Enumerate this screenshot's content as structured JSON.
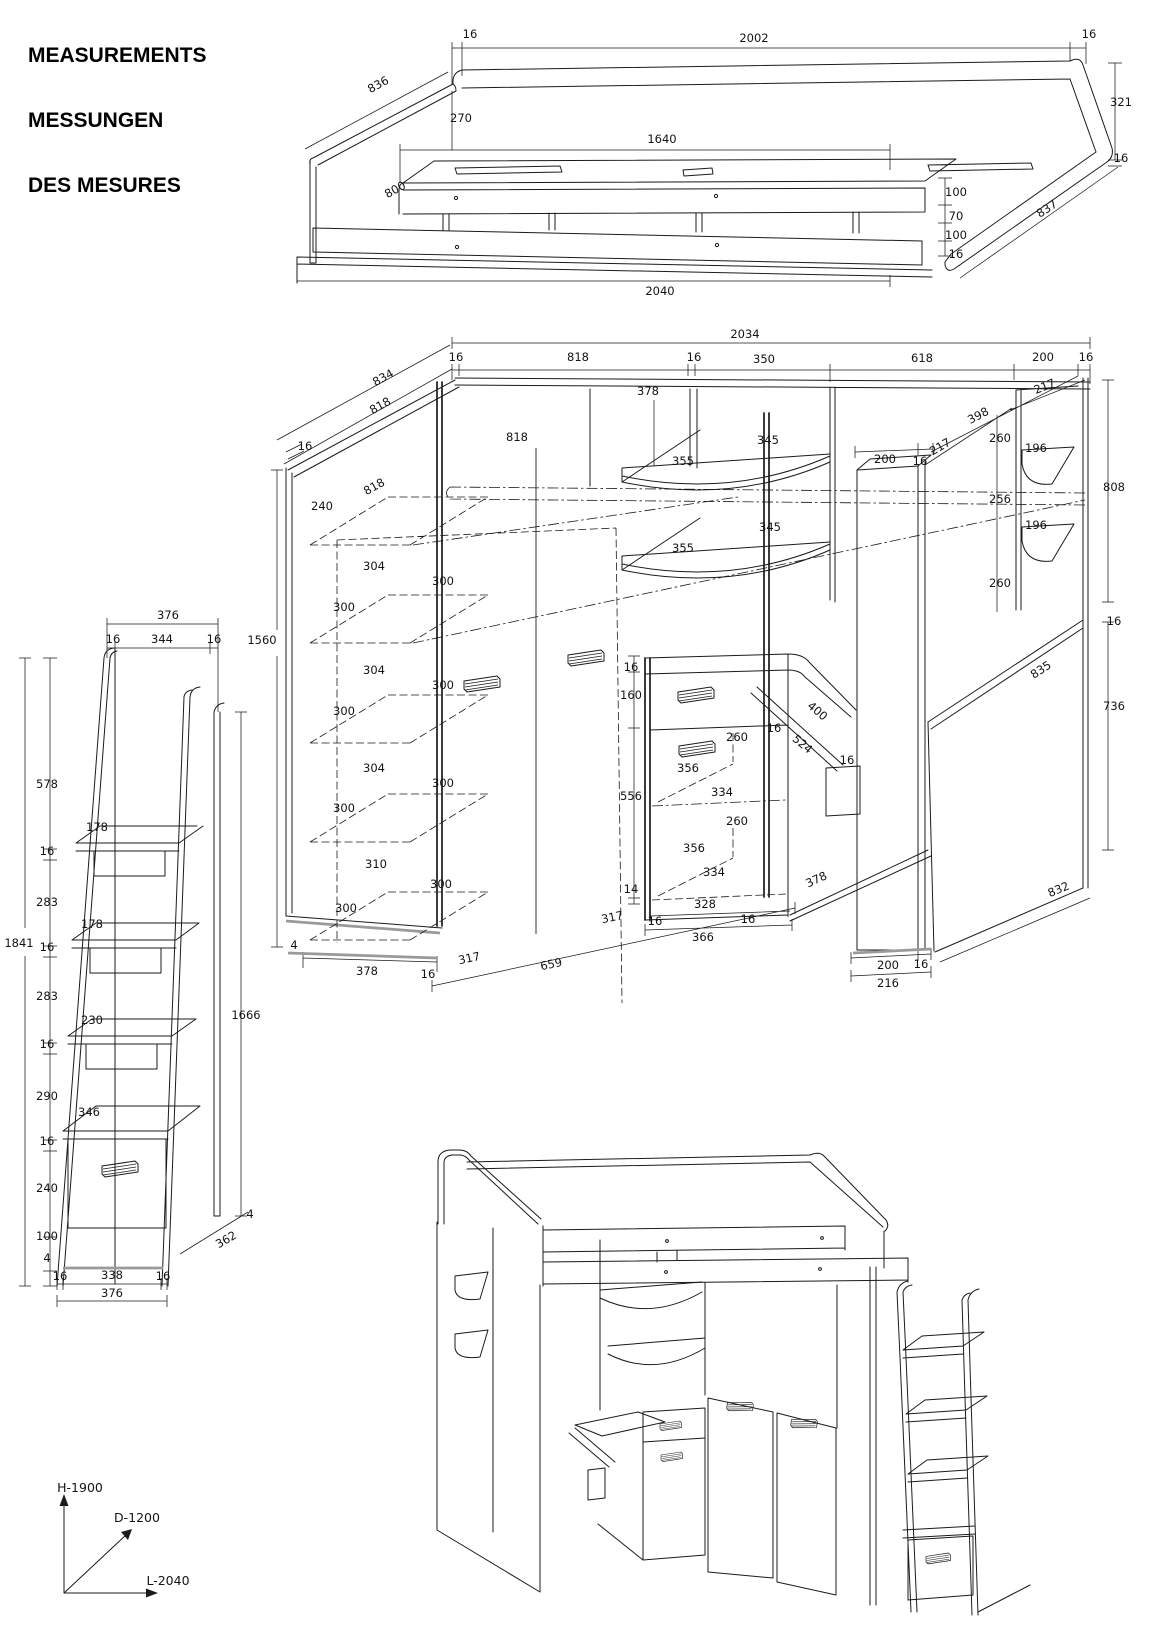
{
  "title": {
    "en": "MEASUREMENTS",
    "de": "MESSUNGEN",
    "fr": "DES MESURES"
  },
  "axes": {
    "height": "H-1900",
    "depth": "D-1200",
    "length": "L-2040"
  },
  "views": {
    "bed": {
      "name": "bed-frame-isometric",
      "labels": [
        {
          "x": 470,
          "y": 38,
          "t": "16"
        },
        {
          "x": 754,
          "y": 42,
          "t": "2002"
        },
        {
          "x": 1089,
          "y": 38,
          "t": "16"
        },
        {
          "x": 380,
          "y": 88,
          "t": "836",
          "r": -29
        },
        {
          "x": 461,
          "y": 122,
          "t": "270"
        },
        {
          "x": 662,
          "y": 143,
          "t": "1640"
        },
        {
          "x": 397,
          "y": 193,
          "t": "800",
          "r": -29
        },
        {
          "x": 1121,
          "y": 106,
          "t": "321",
          "a": "start"
        },
        {
          "x": 1121,
          "y": 162,
          "t": "16",
          "a": "start"
        },
        {
          "x": 956,
          "y": 196,
          "t": "100",
          "a": "start"
        },
        {
          "x": 956,
          "y": 220,
          "t": "70",
          "a": "start"
        },
        {
          "x": 956,
          "y": 239,
          "t": "100",
          "a": "start"
        },
        {
          "x": 956,
          "y": 258,
          "t": "16",
          "a": "start"
        },
        {
          "x": 1049,
          "y": 212,
          "t": "837",
          "r": -33
        },
        {
          "x": 660,
          "y": 295,
          "t": "2040"
        }
      ]
    },
    "unit": {
      "name": "wardrobe-desk-unit-isometric",
      "labels": [
        {
          "x": 745,
          "y": 338,
          "t": "2034"
        },
        {
          "x": 456,
          "y": 361,
          "t": "16"
        },
        {
          "x": 578,
          "y": 361,
          "t": "818"
        },
        {
          "x": 694,
          "y": 361,
          "t": "16"
        },
        {
          "x": 764,
          "y": 363,
          "t": "350"
        },
        {
          "x": 922,
          "y": 362,
          "t": "618"
        },
        {
          "x": 1043,
          "y": 361,
          "t": "200"
        },
        {
          "x": 1086,
          "y": 361,
          "t": "16"
        },
        {
          "x": 385,
          "y": 381,
          "t": "834",
          "r": -29
        },
        {
          "x": 382,
          "y": 409,
          "t": "818",
          "r": -29
        },
        {
          "x": 648,
          "y": 395,
          "t": "378"
        },
        {
          "x": 517,
          "y": 441,
          "t": "818"
        },
        {
          "x": 305,
          "y": 450,
          "t": "16"
        },
        {
          "x": 376,
          "y": 490,
          "t": "818",
          "r": -29
        },
        {
          "x": 322,
          "y": 510,
          "t": "240"
        },
        {
          "x": 262,
          "y": 644,
          "t": "1560"
        },
        {
          "x": 374,
          "y": 570,
          "t": "304"
        },
        {
          "x": 443,
          "y": 585,
          "t": "300"
        },
        {
          "x": 344,
          "y": 611,
          "t": "300"
        },
        {
          "x": 374,
          "y": 674,
          "t": "304"
        },
        {
          "x": 443,
          "y": 689,
          "t": "300"
        },
        {
          "x": 344,
          "y": 715,
          "t": "300"
        },
        {
          "x": 374,
          "y": 772,
          "t": "304"
        },
        {
          "x": 443,
          "y": 787,
          "t": "300"
        },
        {
          "x": 344,
          "y": 812,
          "t": "300"
        },
        {
          "x": 376,
          "y": 868,
          "t": "310"
        },
        {
          "x": 441,
          "y": 888,
          "t": "300"
        },
        {
          "x": 346,
          "y": 912,
          "t": "300"
        },
        {
          "x": 294,
          "y": 949,
          "t": "4"
        },
        {
          "x": 367,
          "y": 975,
          "t": "378"
        },
        {
          "x": 683,
          "y": 465,
          "t": "355"
        },
        {
          "x": 768,
          "y": 444,
          "t": "345"
        },
        {
          "x": 683,
          "y": 552,
          "t": "355"
        },
        {
          "x": 770,
          "y": 531,
          "t": "345"
        },
        {
          "x": 885,
          "y": 463,
          "t": "200"
        },
        {
          "x": 920,
          "y": 465,
          "t": "16"
        },
        {
          "x": 942,
          "y": 450,
          "t": "217",
          "r": -30
        },
        {
          "x": 980,
          "y": 419,
          "t": "398",
          "r": -28
        },
        {
          "x": 1046,
          "y": 390,
          "t": "217",
          "r": -22
        },
        {
          "x": 1000,
          "y": 442,
          "t": "260",
          "a": "end"
        },
        {
          "x": 1036,
          "y": 452,
          "t": "196"
        },
        {
          "x": 1000,
          "y": 503,
          "t": "256",
          "a": "end"
        },
        {
          "x": 1036,
          "y": 529,
          "t": "196"
        },
        {
          "x": 1000,
          "y": 587,
          "t": "260",
          "a": "end"
        },
        {
          "x": 1114,
          "y": 491,
          "t": "808",
          "a": "start"
        },
        {
          "x": 1114,
          "y": 625,
          "t": "16",
          "a": "start"
        },
        {
          "x": 1043,
          "y": 673,
          "t": "835",
          "r": -33
        },
        {
          "x": 1114,
          "y": 710,
          "t": "736",
          "a": "start"
        },
        {
          "x": 1060,
          "y": 893,
          "t": "832",
          "r": -23
        },
        {
          "x": 631,
          "y": 671,
          "t": "16",
          "a": "end"
        },
        {
          "x": 631,
          "y": 699,
          "t": "160",
          "a": "end"
        },
        {
          "x": 631,
          "y": 800,
          "t": "556",
          "a": "end"
        },
        {
          "x": 631,
          "y": 893,
          "t": "14",
          "a": "end"
        },
        {
          "x": 737,
          "y": 741,
          "t": "260"
        },
        {
          "x": 688,
          "y": 772,
          "t": "356"
        },
        {
          "x": 722,
          "y": 796,
          "t": "334"
        },
        {
          "x": 737,
          "y": 825,
          "t": "260"
        },
        {
          "x": 694,
          "y": 852,
          "t": "356"
        },
        {
          "x": 714,
          "y": 876,
          "t": "334"
        },
        {
          "x": 705,
          "y": 908,
          "t": "328"
        },
        {
          "x": 703,
          "y": 941,
          "t": "366"
        },
        {
          "x": 655,
          "y": 925,
          "t": "16"
        },
        {
          "x": 748,
          "y": 923,
          "t": "16"
        },
        {
          "x": 815,
          "y": 714,
          "t": "400",
          "r": 40
        },
        {
          "x": 774,
          "y": 732,
          "t": "16"
        },
        {
          "x": 800,
          "y": 747,
          "t": "524",
          "r": 40
        },
        {
          "x": 847,
          "y": 764,
          "t": "16"
        },
        {
          "x": 818,
          "y": 883,
          "t": "378",
          "r": -25
        },
        {
          "x": 613,
          "y": 921,
          "t": "317",
          "r": -12
        },
        {
          "x": 470,
          "y": 962,
          "t": "317",
          "r": -12
        },
        {
          "x": 552,
          "y": 968,
          "t": "659",
          "r": -12
        },
        {
          "x": 428,
          "y": 978,
          "t": "16"
        },
        {
          "x": 888,
          "y": 969,
          "t": "200"
        },
        {
          "x": 921,
          "y": 968,
          "t": "16"
        },
        {
          "x": 888,
          "y": 987,
          "t": "216"
        }
      ]
    },
    "ladder": {
      "name": "ladder-side-elevation",
      "labels": [
        {
          "x": 168,
          "y": 619,
          "t": "376"
        },
        {
          "x": 113,
          "y": 643,
          "t": "16"
        },
        {
          "x": 162,
          "y": 643,
          "t": "344"
        },
        {
          "x": 214,
          "y": 643,
          "t": "16"
        },
        {
          "x": 47,
          "y": 788,
          "t": "578",
          "a": "end"
        },
        {
          "x": 47,
          "y": 855,
          "t": "16",
          "a": "end"
        },
        {
          "x": 47,
          "y": 906,
          "t": "283",
          "a": "end"
        },
        {
          "x": 47,
          "y": 951,
          "t": "16",
          "a": "end"
        },
        {
          "x": 47,
          "y": 1000,
          "t": "283",
          "a": "end"
        },
        {
          "x": 47,
          "y": 1048,
          "t": "16",
          "a": "end"
        },
        {
          "x": 47,
          "y": 1100,
          "t": "290",
          "a": "end"
        },
        {
          "x": 47,
          "y": 1145,
          "t": "16",
          "a": "end"
        },
        {
          "x": 47,
          "y": 1192,
          "t": "240",
          "a": "end"
        },
        {
          "x": 47,
          "y": 1240,
          "t": "100",
          "a": "end"
        },
        {
          "x": 47,
          "y": 1262,
          "t": "4",
          "a": "end"
        },
        {
          "x": 19,
          "y": 947,
          "t": "1841"
        },
        {
          "x": 97,
          "y": 831,
          "t": "178"
        },
        {
          "x": 92,
          "y": 928,
          "t": "178"
        },
        {
          "x": 92,
          "y": 1024,
          "t": "230"
        },
        {
          "x": 89,
          "y": 1116,
          "t": "346"
        },
        {
          "x": 246,
          "y": 1019,
          "t": "1666",
          "a": "start"
        },
        {
          "x": 250,
          "y": 1218,
          "t": "4",
          "a": "start"
        },
        {
          "x": 228,
          "y": 1243,
          "t": "362",
          "r": -30
        },
        {
          "x": 60,
          "y": 1280,
          "t": "16"
        },
        {
          "x": 112,
          "y": 1279,
          "t": "338"
        },
        {
          "x": 163,
          "y": 1280,
          "t": "16"
        },
        {
          "x": 112,
          "y": 1297,
          "t": "376"
        }
      ]
    },
    "persp": {
      "name": "assembled-3d-view",
      "labels": []
    }
  }
}
